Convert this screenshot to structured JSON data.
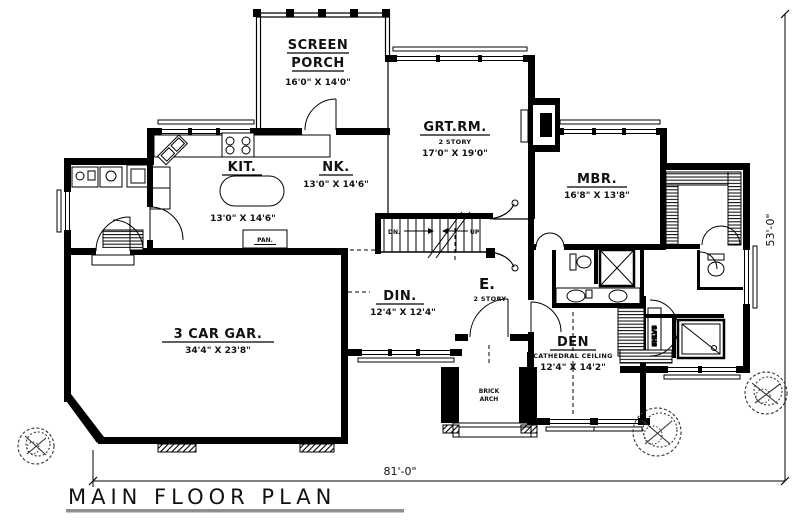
{
  "title": "MAIN FLOOR PLAN",
  "dimensions": {
    "overall_width": "81'-0\"",
    "overall_depth": "53'-0\""
  },
  "rooms": {
    "screen_porch": {
      "line1": "SCREEN",
      "line2": "PORCH",
      "dims": "16'0\" X 14'0\""
    },
    "kitchen": {
      "name": "KIT.",
      "dims": "13'0\" X 14'6\""
    },
    "nook": {
      "name": "NK.",
      "dims": "13'0\" X 14'6\""
    },
    "great_room": {
      "name": "GRT.RM.",
      "story": "2 STORY",
      "dims": "17'0\" X 19'0\""
    },
    "master_bedroom": {
      "name": "MBR.",
      "dims": "16'8\" X 13'8\""
    },
    "dining": {
      "name": "DIN.",
      "dims": "12'4\" X 12'4\""
    },
    "entry": {
      "name": "E.",
      "story": "2 STORY"
    },
    "den": {
      "name": "DEN",
      "ceiling": "CATHEDRAL CEILING",
      "dims": "12'4\" X 14'2\""
    },
    "garage": {
      "name": "3 CAR GAR.",
      "dims": "34'4\" X 23'8\""
    }
  },
  "labels": {
    "pantry": "PAN.",
    "brick_arch_line1": "BRICK",
    "brick_arch_line2": "ARCH",
    "shelves": "SHLVS",
    "stairs_down": "DN.",
    "stairs_up": "UP"
  }
}
